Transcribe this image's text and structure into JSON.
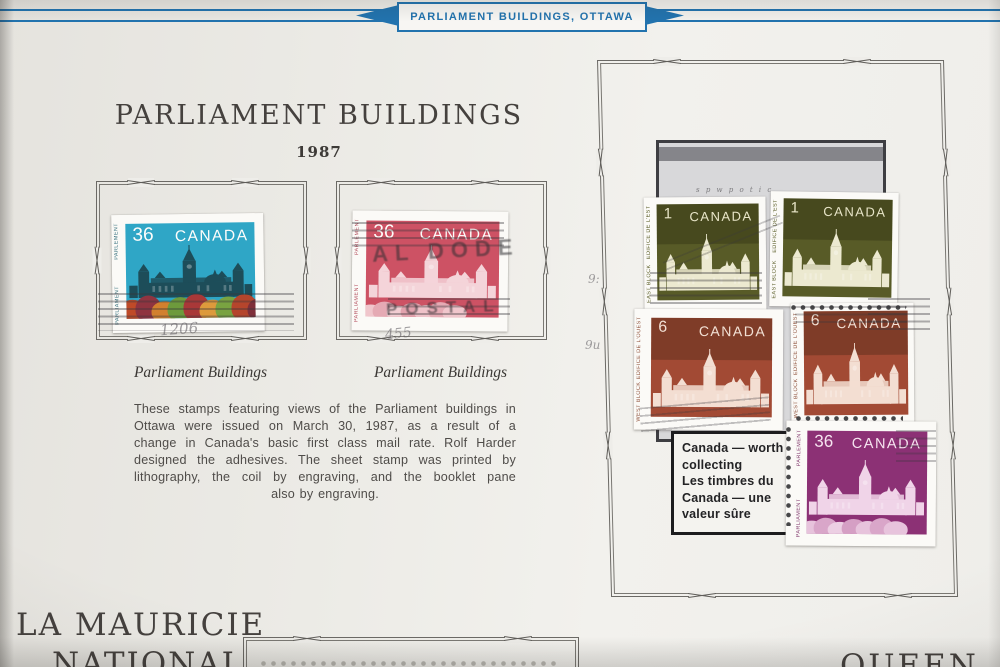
{
  "banner": {
    "label": "PARLIAMENT BUILDINGS, OTTAWA",
    "accent_color": "#2273ae"
  },
  "left_section": {
    "title": "PARLIAMENT BUILDINGS",
    "year": "1987",
    "stamps": [
      {
        "denomination": "36",
        "country": "CANADA",
        "inscription_top": "PARLEMENT",
        "inscription_bottom": "PARLIAMENT",
        "caption": "Parliament Buildings",
        "sky_color": "#2fa6c6",
        "pencil_note": "1206"
      },
      {
        "denomination": "36",
        "country": "CANADA",
        "inscription_top": "PARLEMENT",
        "inscription_bottom": "PARLIAMENT",
        "caption": "Parliament Buildings",
        "panel_color": "#cd5264",
        "postmark_line1": "AL DODE",
        "postmark_line2": "POSTAL",
        "pencil_note": "455"
      }
    ],
    "description_lines": [
      "These stamps featuring views of the Parliament buildings in",
      "Ottawa were issued on March 30, 1987, as a result of a",
      "change in Canada's basic first class mail rate. Rolf Harder",
      "designed the adhesives. The sheet stamp was printed by",
      "lithography, the coil by engraving, and the booklet pane",
      "also by engraving."
    ]
  },
  "right_panel": {
    "stamps": [
      {
        "denomination": "1",
        "country": "CANADA",
        "inscription_top": "ÉDIFICE DE L'EST",
        "inscription_bottom": "EAST BLOCK",
        "panel_color": "#585b27"
      },
      {
        "denomination": "1",
        "country": "CANADA",
        "inscription_top": "ÉDIFICE DE L'EST",
        "inscription_bottom": "EAST BLOCK",
        "panel_color": "#585b27"
      },
      {
        "denomination": "6",
        "country": "CANADA",
        "inscription_top": "ÉDIFICE DE L'OUEST",
        "inscription_bottom": "WEST BLOCK",
        "panel_color": "#a24a34"
      },
      {
        "denomination": "6",
        "country": "CANADA",
        "inscription_top": "ÉDIFICE DE L'OUEST",
        "inscription_bottom": "WEST BLOCK",
        "panel_color": "#a24a34"
      },
      {
        "denomination": "36",
        "country": "CANADA",
        "inscription_top": "PARLEMENT",
        "inscription_bottom": "PARLIAMENT",
        "panel_color": "#8c3175"
      }
    ],
    "label_lines": [
      "Canada — worth",
      "collecting",
      "Les timbres du",
      "Canada — une",
      "valeur sûre"
    ],
    "pencil_notes": [
      "9:",
      "9u"
    ]
  },
  "bottom": {
    "left_title_line1": "LA MAURICIE",
    "left_title_line2": "NATIONAL",
    "right_title": "QUEEN"
  }
}
